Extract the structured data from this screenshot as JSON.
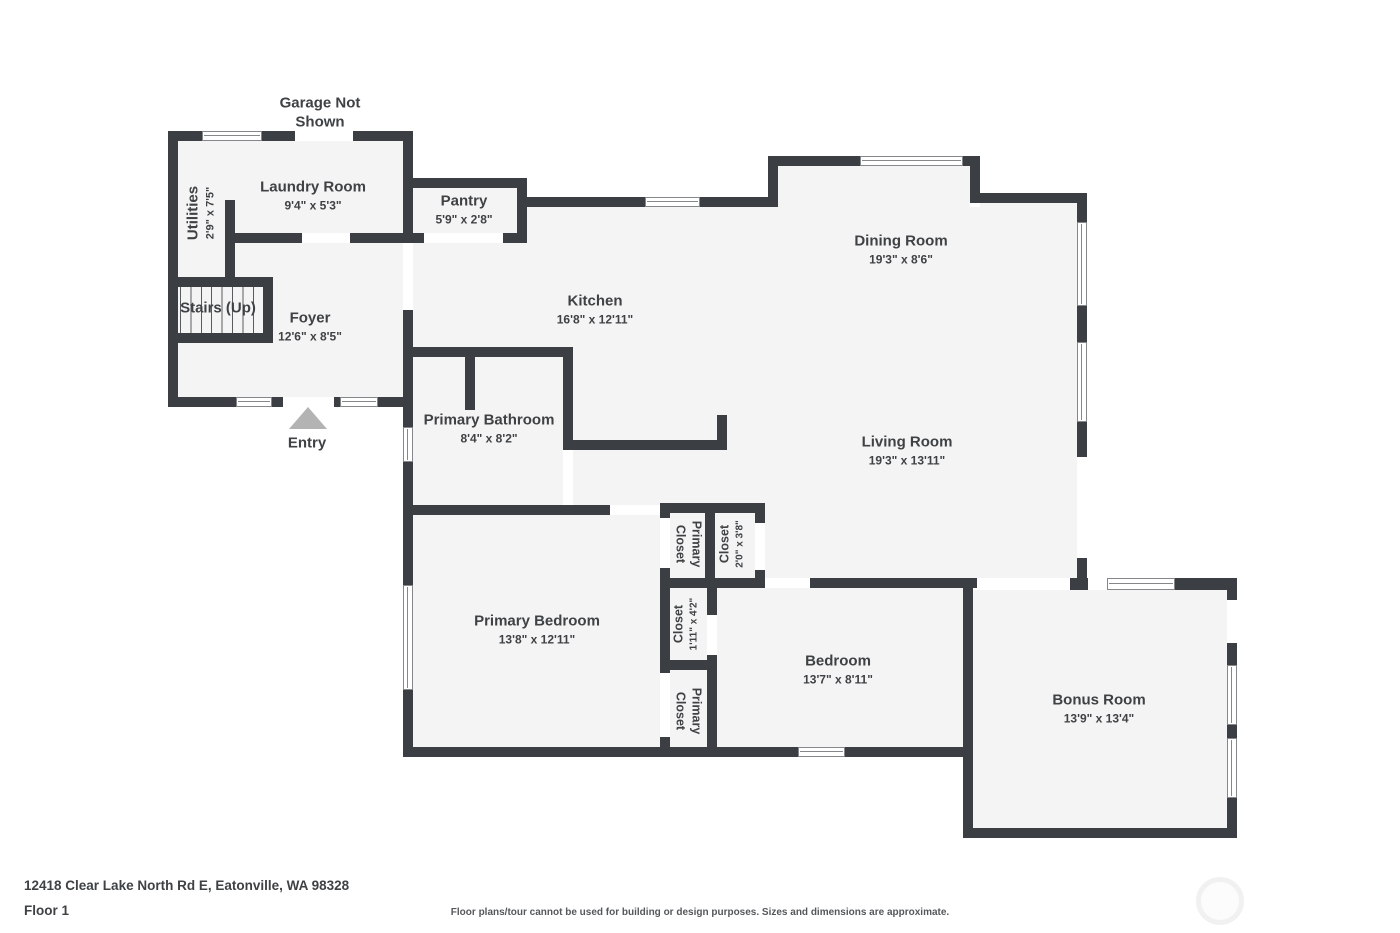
{
  "colors": {
    "wall": "#3b3e42",
    "floor": "#f4f4f4",
    "text": "#3f4245",
    "arrow": "#b3b3b3"
  },
  "notes": {
    "garage_line1": "Garage Not",
    "garage_line2": "Shown",
    "entry": "Entry"
  },
  "rooms": {
    "laundry": {
      "name": "Laundry Room",
      "dims": "9'4\" x 5'3\""
    },
    "utilities": {
      "name": "Utilities",
      "dims": "2'9\" x 7'5\""
    },
    "pantry": {
      "name": "Pantry",
      "dims": "5'9\" x 2'8\""
    },
    "stairs": {
      "name": "Stairs (Up)"
    },
    "foyer": {
      "name": "Foyer",
      "dims": "12'6\" x 8'5\""
    },
    "kitchen": {
      "name": "Kitchen",
      "dims": "16'8\" x 12'11\""
    },
    "dining": {
      "name": "Dining Room",
      "dims": "19'3\" x 8'6\""
    },
    "living": {
      "name": "Living Room",
      "dims": "19'3\" x 13'11\""
    },
    "primary_bathroom": {
      "name": "Primary Bathroom",
      "dims": "8'4\" x 8'2\""
    },
    "primary_closet_upper": {
      "line1": "Primary",
      "line2": "Closet"
    },
    "closet_upper": {
      "name": "Closet",
      "dims": "2'0\" x 3'8\""
    },
    "primary_bedroom": {
      "name": "Primary Bedroom",
      "dims": "13'8\" x 12'11\""
    },
    "closet_middle": {
      "name": "Closet",
      "dims": "1'11\" x 4'2\""
    },
    "primary_closet_lower": {
      "line1": "Primary",
      "line2": "Closet"
    },
    "bedroom": {
      "name": "Bedroom",
      "dims": "13'7\" x 8'11\""
    },
    "bonus": {
      "name": "Bonus Room",
      "dims": "13'9\" x 13'4\""
    }
  },
  "footer": {
    "address": "12418 Clear Lake North Rd E, Eatonville, WA 98328",
    "floor_label": "Floor 1",
    "disclaimer": "Floor plans/tour cannot be used for building or design purposes. Sizes and dimensions are approximate."
  }
}
